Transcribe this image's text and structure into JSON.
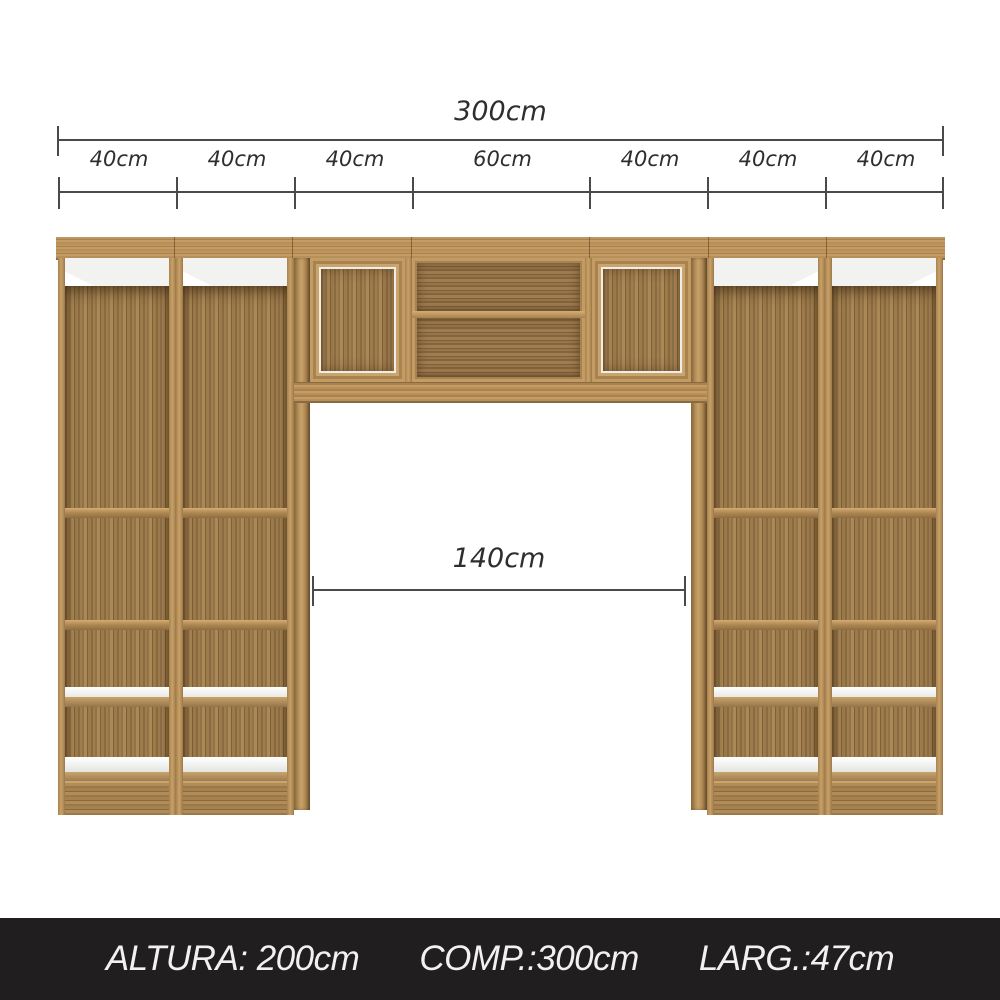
{
  "dimensions": {
    "total_label": "300cm",
    "segments": [
      "40cm",
      "40cm",
      "40cm",
      "60cm",
      "40cm",
      "40cm",
      "40cm"
    ],
    "opening_label": "140cm"
  },
  "footer": {
    "height_label": "ALTURA: 200cm",
    "length_label": "COMP.:300cm",
    "width_label": "LARG.:47cm"
  },
  "colors": {
    "wood_frame": "#c7a168",
    "wood_back": "#9a7a4b",
    "wood_dark": "#7f6139",
    "shelf_white": "#f1f1ef",
    "rail_gray": "#8a8a8a",
    "dimension_line": "#4a4a4a",
    "dimension_text": "#2e2e2e",
    "footer_bg": "#211e1f",
    "footer_text": "#f1f1f1",
    "background": "#ffffff"
  }
}
